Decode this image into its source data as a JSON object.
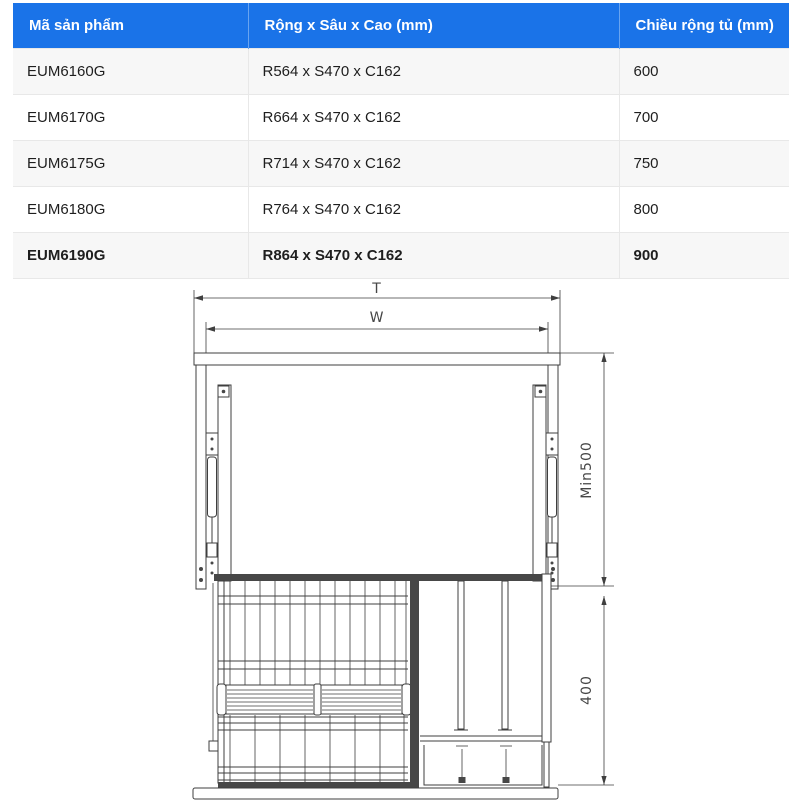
{
  "table": {
    "headers": [
      "Mã sản phẩm",
      "Rộng x Sâu x Cao (mm)",
      "Chiều rộng tủ (mm)"
    ],
    "rows": [
      {
        "code": "EUM6160G",
        "dimensions": "R564 x S470 x C162",
        "cabinet_width": "600"
      },
      {
        "code": "EUM6170G",
        "dimensions": "R664 x S470 x C162",
        "cabinet_width": "700"
      },
      {
        "code": "EUM6175G",
        "dimensions": "R714 x S470 x C162",
        "cabinet_width": "750"
      },
      {
        "code": "EUM6180G",
        "dimensions": "R764 x S470 x C162",
        "cabinet_width": "800"
      },
      {
        "code": "EUM6190G",
        "dimensions": "R864 x S470 x C162",
        "cabinet_width": "900",
        "highlighted": true
      }
    ]
  },
  "diagram": {
    "labels": {
      "total_width": "T",
      "inner_width": "W",
      "min_install_height": "Min500",
      "basket_height": "400"
    }
  },
  "colors": {
    "header_bg": "#1a73e8",
    "header_text": "#ffffff",
    "stripe_bg": "#f7f7f7",
    "line": "#3f3f3f"
  }
}
